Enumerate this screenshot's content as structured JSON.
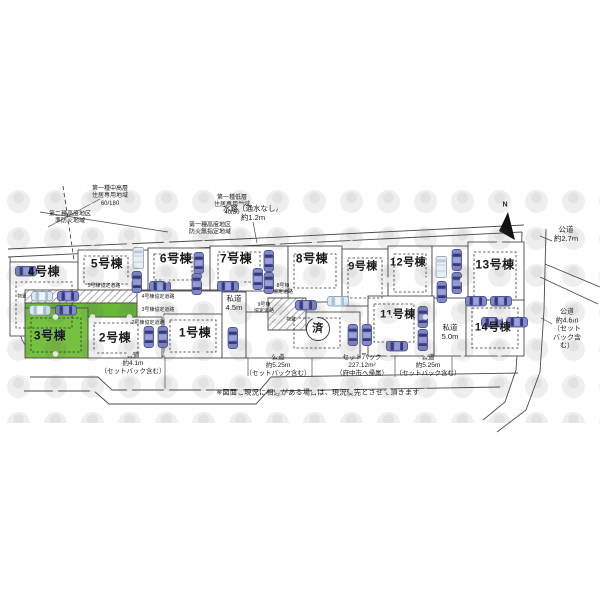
{
  "title": "区画図（全14区画 配置図）",
  "colors": {
    "highlight_green": "#76c140",
    "agreement_road_green": "#69b936",
    "car_blue": "#8188cb",
    "car_light": "#d9e9f4"
  },
  "compass": {
    "north_label": "N"
  },
  "zoning": {
    "z1": "第一種中高層\n住居専用地域\n60/180",
    "z2": "第一種低層\n住居専用地域\n40/80",
    "z3": "第二種高度地区\n準防火地域",
    "z4": "第一種高度地区\n防火無指定地域"
  },
  "roads": {
    "waterway": "水路（通水なし）\n約1.2m",
    "public_top_right": "公道\n約2.7m",
    "public_right": "公道\n約4.6m\n（セットバック含む）",
    "public_bottom_left": "公道\n約4.1m\n（セットバック含む）",
    "public_bottom_1": "公道\n約5.25m\n（セットバック含む）",
    "setback": "セットバック\n227.12m²\n（府中市へ帰属）",
    "public_bottom_2": "公道\n約5.25m\n（セットバック含む）",
    "private_1": "私道\n4.5m",
    "private_2": "私道\n5.0m"
  },
  "agreement_roads": {
    "r5": "5号棟協定道路",
    "r4": "4号棟協定道路",
    "r3": "3号棟協定道路",
    "r2": "2号棟協定道路",
    "r8": "8号棟\n協定道路",
    "r9": "9号棟\n協定道路"
  },
  "lots": {
    "l1": "1号棟",
    "l2": "2号棟",
    "l3": "3号棟",
    "l4": "4号棟",
    "l5": "5号棟",
    "l6": "6号棟",
    "l7": "7号棟",
    "l8": "8号棟",
    "l9": "9号棟",
    "l11": "11号棟",
    "l12": "12号棟",
    "l13": "13号棟",
    "l14": "14号棟",
    "sold": "済"
  },
  "misc": {
    "storage1": "物置",
    "storage2": "物置",
    "note": "※図面と現況に相違がある場合は、現況優先とさせて頂きます"
  }
}
